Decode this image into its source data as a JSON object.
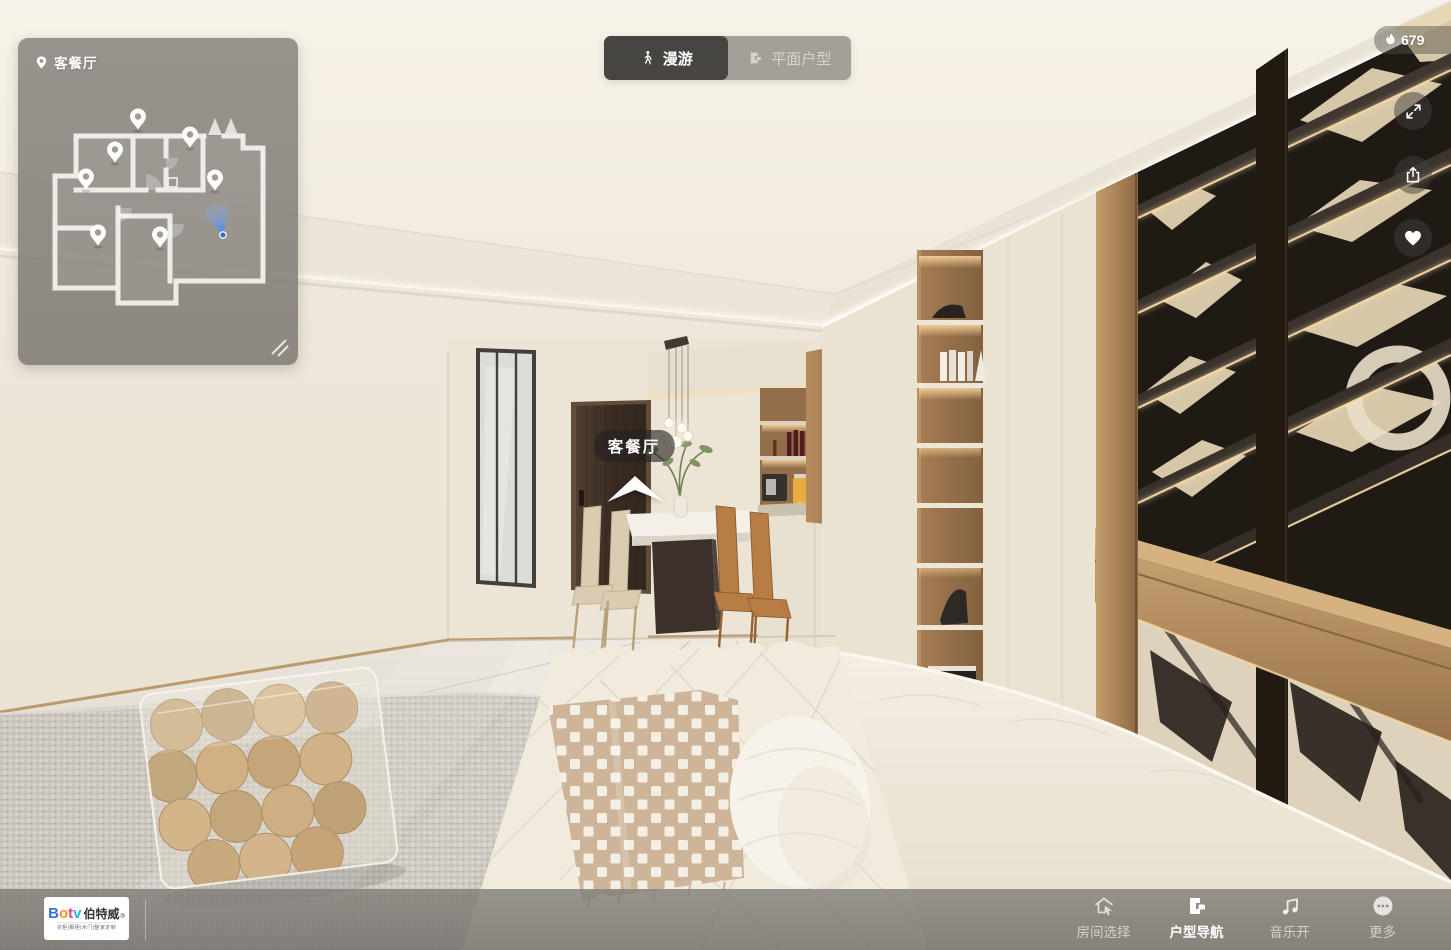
{
  "minimap": {
    "location_icon": "location-pin-icon",
    "location_label": "客餐厅",
    "resize_icon": "resize-handle-icon"
  },
  "view_mode_tabs": {
    "roam": {
      "icon": "walking-person-icon",
      "label": "漫游",
      "active": true
    },
    "floor_plan": {
      "icon": "floorplan-icon",
      "label": "平面户型",
      "active": false
    }
  },
  "heat_counter": {
    "icon": "flame-icon",
    "count": "679"
  },
  "side_actions": {
    "fullscreen": {
      "icon": "fullscreen-expand-icon"
    },
    "share": {
      "icon": "share-icon"
    },
    "favorite": {
      "icon": "heart-icon"
    }
  },
  "scene": {
    "hotspot_label": "客餐厅"
  },
  "bottom_bar": {
    "logo": {
      "letters": [
        {
          "ch": "B",
          "color": "#3a6fd8"
        },
        {
          "ch": "o",
          "color": "#f7941d"
        },
        {
          "ch": "t",
          "color": "#e63a8f"
        },
        {
          "ch": "v",
          "color": "#2bb3e6"
        }
      ],
      "brand_cn": "伯特威",
      "reg_mark": "®",
      "tagline": "衣柜|橱柜|木门|整家定制"
    },
    "items": [
      {
        "icon": "room-select-icon",
        "label": "房间选择",
        "active": false
      },
      {
        "icon": "floorplan-nav-icon",
        "label": "户型导航",
        "active": true
      },
      {
        "icon": "music-note-icon",
        "label": "音乐开",
        "active": false
      },
      {
        "icon": "more-ellipsis-icon",
        "label": "更多",
        "active": false
      }
    ]
  },
  "colors": {
    "viewer_cone_blue": "#4a86e8",
    "led_warm": "#ffd9a0",
    "active_nav": "#ffffff",
    "inactive_nav": "#d6d3cc"
  }
}
